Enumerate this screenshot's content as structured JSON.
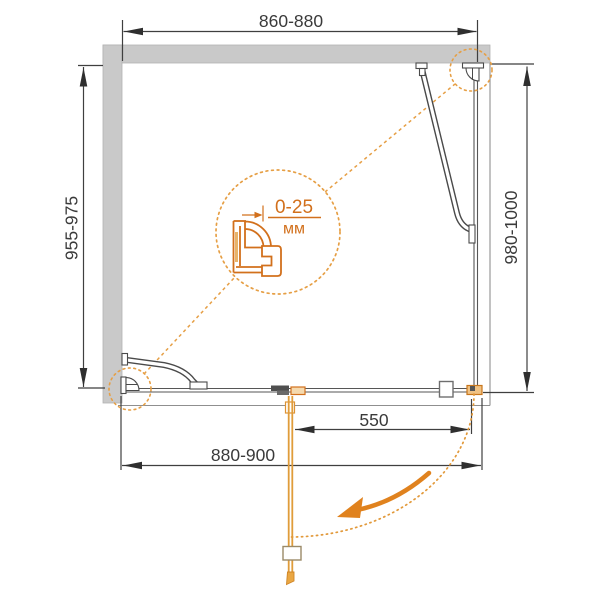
{
  "meta": {
    "drawing_type": "technical-drawing",
    "subject": "shower enclosure top view installation scheme"
  },
  "dims": {
    "top": "860-880",
    "left": "955-975",
    "right": "980-1000",
    "bottom": "880-900",
    "door": "550"
  },
  "detail": {
    "range": "0-25",
    "unit": "мм"
  },
  "colors": {
    "accent_orange": "#d2701c",
    "door_orange": "#e09c3a",
    "wall_gray": "#c9c9c9",
    "line_dark": "#3f3f3f"
  }
}
